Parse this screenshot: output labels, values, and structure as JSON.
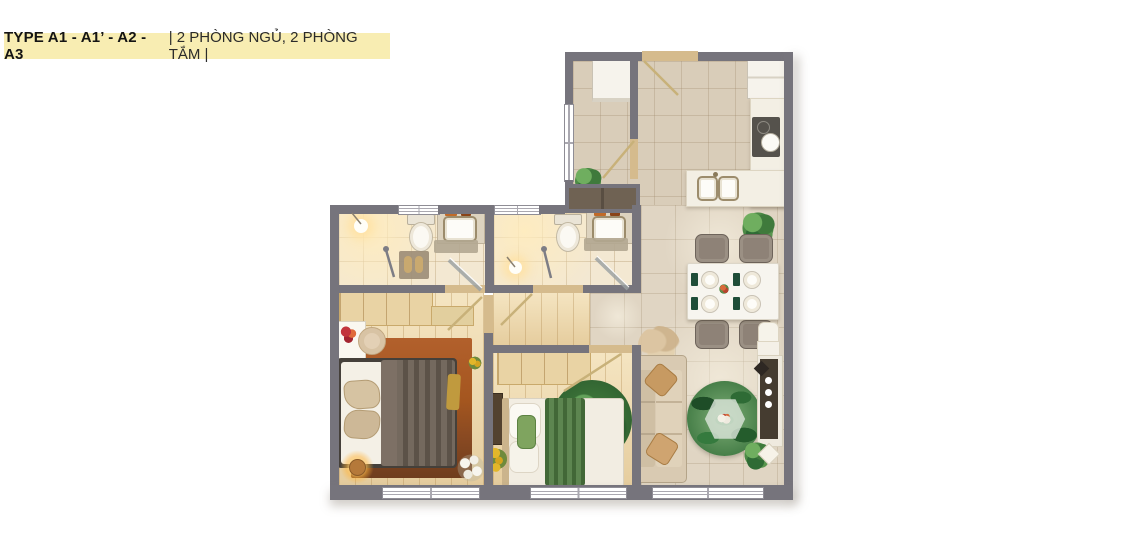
{
  "banner": {
    "type_label": "TYPE A1 - A1’ - A2 - A3",
    "subtitle": "| 2 PHÒNG NGỦ, 2 PHÒNG TẮM |",
    "background": "#F8EDB2",
    "text_color": "#141414"
  },
  "palette": {
    "wall": "#76747C",
    "door_threshold": "#D5BB8D",
    "window_white": "#FFFFFF",
    "tile_floor": "#D9CDB9",
    "living_tile": "#E0D5C3",
    "bath_tile": "#F3E8D2",
    "wood_floor": "#ECD7AB",
    "shaft_brown": "#6F6253",
    "counter_marble": "#F3EFE4",
    "stove_dark": "#55524C",
    "sofa_beige": "#D9CAB2",
    "throw_pillow_tan": "#C79A62",
    "living_rug_green": "#2F6B35",
    "bedroom_rug_rust": "#A85A26",
    "blanket_taupe": "#6B6054",
    "blanket_green": "#4F7C41",
    "dining_chair": "#8E8277",
    "napkin_green": "#1F4D38",
    "lamp_glow": "#FFC76E",
    "sunflower_yellow": "#E2B62A"
  },
  "icons": [
    "washing-machine-icon",
    "fridge-icon",
    "cooktop-icon",
    "kitchen-sink-icon",
    "kitchen-island-icon",
    "dining-table-icon",
    "dining-chair-icon",
    "plate-setting-icon",
    "potted-plant-icon",
    "pampas-grass-icon",
    "sofa-icon",
    "throw-pillow-icon",
    "round-leaf-rug-icon",
    "hexagon-coffee-table-icon",
    "tv-console-icon",
    "toilet-icon",
    "vanity-sink-icon",
    "shower-icon",
    "pendant-light-icon",
    "bath-mat-icon",
    "slippers-icon",
    "wardrobe-icon",
    "double-bed-icon",
    "single-bed-icon",
    "vanity-desk-icon",
    "vanity-stool-icon",
    "bedside-lamp-icon",
    "sunflower-icon",
    "door-swing-icon",
    "window-icon",
    "ac-shaft-icon",
    "flower-vase-icon"
  ]
}
